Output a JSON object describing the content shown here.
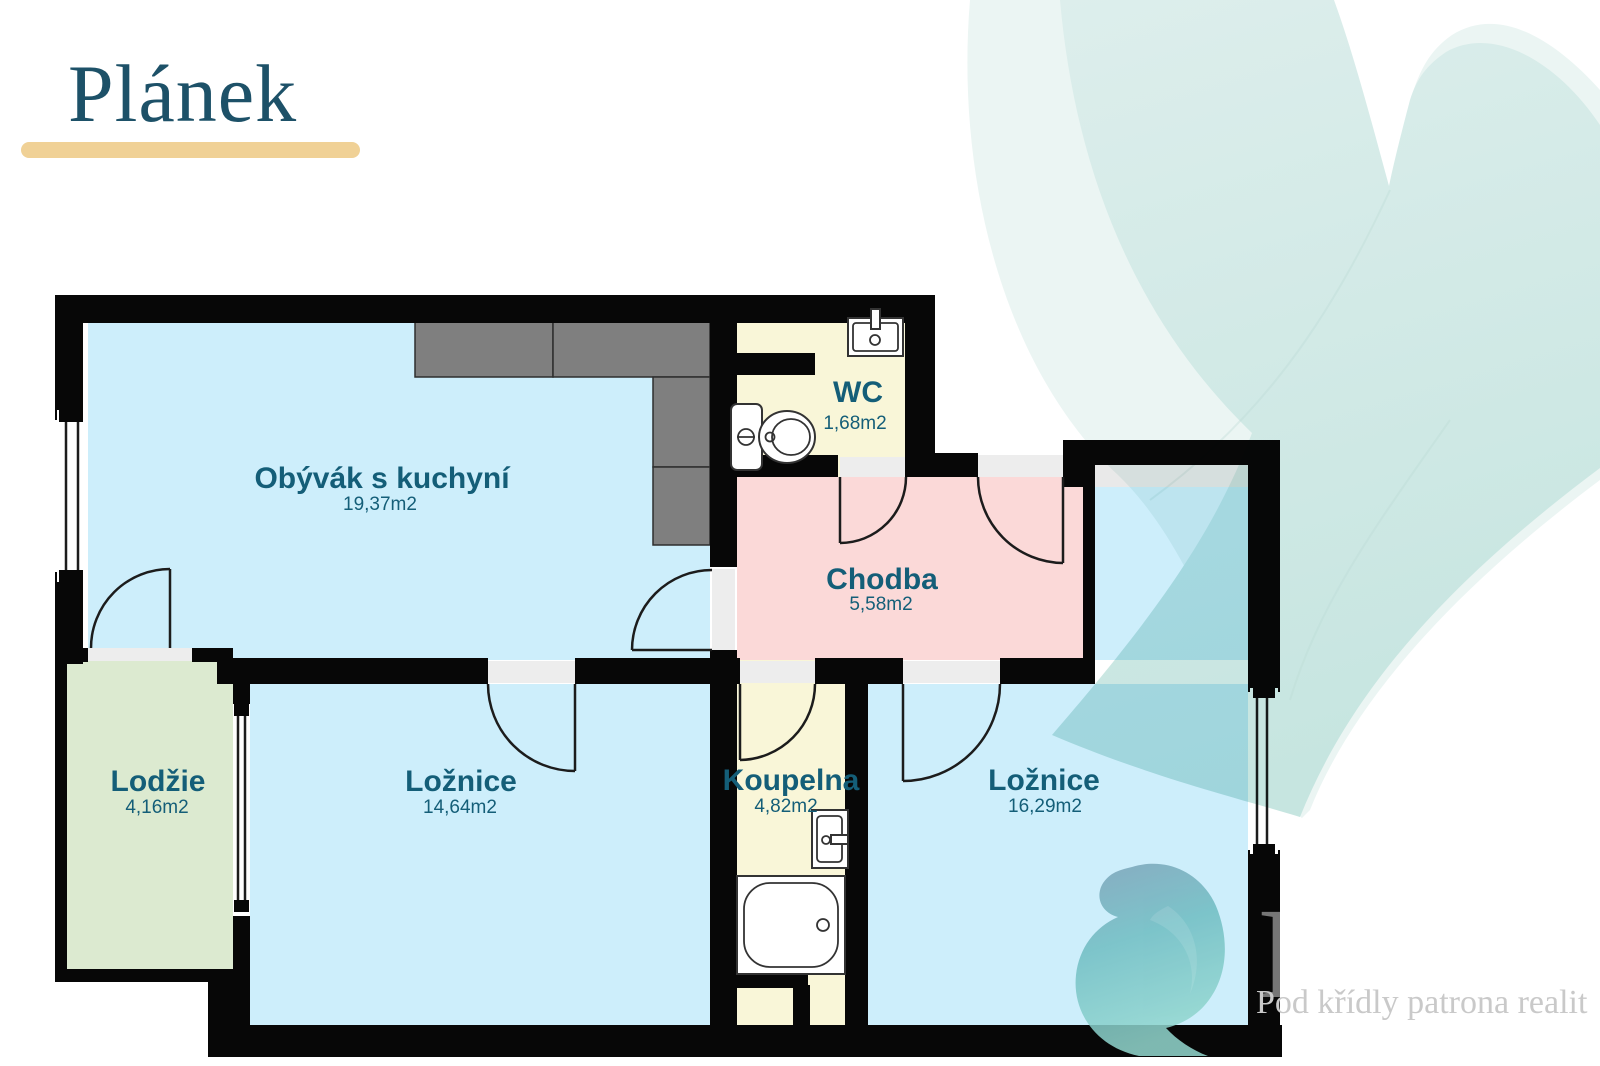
{
  "title": "Plánek",
  "rooms": [
    {
      "id": "living",
      "name": "Obývák s kuchyní",
      "area": "19,37m2"
    },
    {
      "id": "wc",
      "name": "WC",
      "area": "1,68m2"
    },
    {
      "id": "chodba",
      "name": "Chodba",
      "area": "5,58m2"
    },
    {
      "id": "lodzie",
      "name": "Lodžie",
      "area": "4,16m2"
    },
    {
      "id": "bedroom1",
      "name": "Ložnice",
      "area": "14,64m2"
    },
    {
      "id": "koupelna",
      "name": "Koupelna",
      "area": "4,82m2"
    },
    {
      "id": "bedroom2",
      "name": "Ložnice",
      "area": "16,29m2"
    }
  ],
  "watermark": {
    "letter": "P",
    "tagline": "Pod křídly patrona realit"
  },
  "fixtures": [
    "toilet-icon",
    "sink-icon",
    "bathtub-icon",
    "kitchen-counter"
  ],
  "colors": {
    "title": "#1d5168",
    "title_underline": "#f0d196",
    "label_text": "#145e78",
    "wall": "#070707",
    "floor_living": "#cdeefb",
    "floor_bath": "#f9f6d8",
    "floor_hall": "#fbd9d8",
    "floor_loggia": "#dcead0",
    "kitchen_counter": "#7f7f7f",
    "threshold": "#ededed",
    "feather_decoration": "#cde9e5",
    "swirl_logo": "#6fbdc2",
    "watermark_text": "#c9c9c9"
  }
}
